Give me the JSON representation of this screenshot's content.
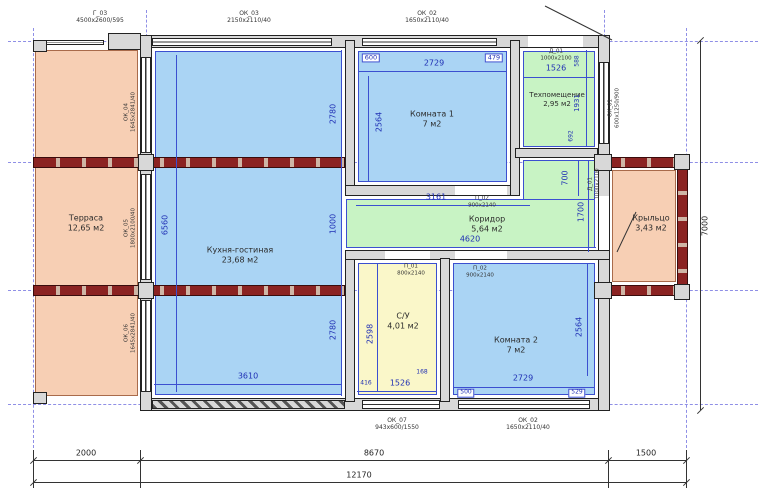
{
  "rooms": [
    {
      "name": "Терраса",
      "area": "12,65 м2"
    },
    {
      "name": "Кухня-гостиная",
      "area": "23,68 м2"
    },
    {
      "name": "Комната 1",
      "area": "7 м2"
    },
    {
      "name": "Техпомещение",
      "area": "2,95 м2"
    },
    {
      "name": "Коридор",
      "area": "5,64 м2"
    },
    {
      "name": "С/У",
      "area": "4,01 м2"
    },
    {
      "name": "Комната 2",
      "area": "7 м2"
    },
    {
      "name": "Крыльцо",
      "area": "3,43 м2"
    }
  ],
  "openings": {
    "g03": {
      "code": "Г_03",
      "size": "4500x2600/595"
    },
    "ok03": {
      "code": "ОК_03",
      "size": "2150x2110/40"
    },
    "ok02": {
      "code": "ОК_02",
      "size": "1650x2110/40"
    },
    "d01": {
      "code": "Д_01",
      "size": "1000x2100"
    },
    "ok01": {
      "code": "ОК_01",
      "size": "600x1250/900"
    },
    "ok04": {
      "code": "ОК_04",
      "size": "1645x2841/40"
    },
    "ok05": {
      "code": "ОК_05",
      "size": "1800x2100/40"
    },
    "ok06": {
      "code": "ОК_06",
      "size": "1645x2841/40"
    },
    "ok07": {
      "code": "ОК_07",
      "size": "943x600/1550"
    },
    "p01": {
      "code": "П_01",
      "size": "800x2140"
    },
    "p02": {
      "code": "П_02",
      "size": "900x2140"
    }
  },
  "dims": {
    "d600": "600",
    "d2729": "2729",
    "d479": "479",
    "d2564": "2564",
    "d2780": "2780",
    "d1526": "1526",
    "d588": "588",
    "d1931": "1931",
    "d692": "692",
    "d3161": "3161",
    "d4620": "4620",
    "d700": "700",
    "d1700": "1700",
    "d1000": "1000",
    "d6560": "6560",
    "d3610": "3610",
    "d2598": "2598",
    "d416": "416",
    "d168": "168",
    "d500": "500",
    "d529": "529",
    "d2000": "2000",
    "d8670": "8670",
    "d1500": "1500",
    "d12170": "12170",
    "d7000": "7000"
  },
  "colors": {
    "blue_room": "#aad4f4",
    "green_room": "#c8f3c4",
    "yellow_room": "#faf7c9",
    "peach_room": "#f7cfb4",
    "wall": "#d8d8d8",
    "beam": "#8b2322",
    "dim_blue": "#3b4fd0",
    "axis": "#8f8fe6"
  }
}
